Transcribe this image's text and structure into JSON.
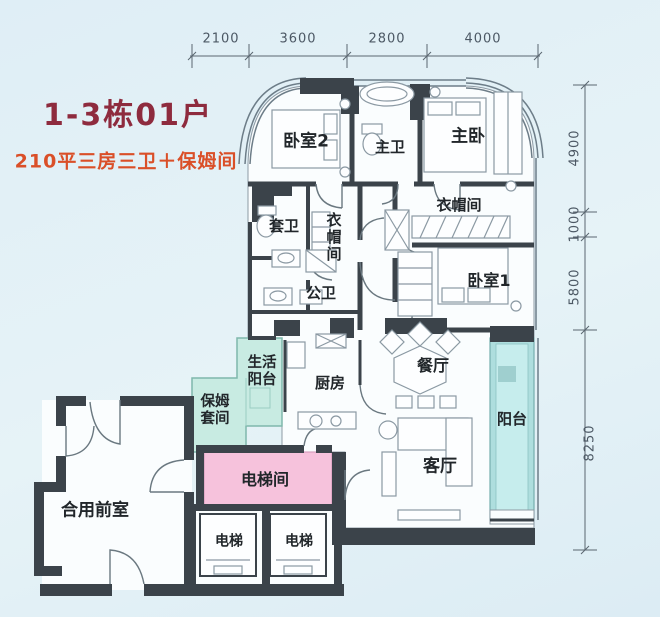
{
  "title": {
    "line1": "1-3栋01户",
    "line2": "210平三房三卫＋保姆间"
  },
  "dimensions": {
    "top": [
      "2100",
      "3600",
      "2800",
      "4000"
    ],
    "right": [
      "4900",
      "1000",
      "5800",
      "8250"
    ]
  },
  "rooms": {
    "bedroom2": "卧室2",
    "master_bath": "主卫",
    "master_bedroom": "主卧",
    "ensuite_bath": "套卫",
    "closet_center": "衣帽间",
    "closet_right": "衣帽间",
    "public_bath": "公卫",
    "bedroom1": "卧室1",
    "dining": "餐厅",
    "kitchen": "厨房",
    "service_balcony": "生活阳台",
    "nanny_suite": "保姆套间",
    "balcony": "阳台",
    "living": "客厅",
    "elevator_hall": "电梯间",
    "elevator": "电梯",
    "shared_vestibule": "合用前室"
  },
  "colors": {
    "background": "#e3f0f6",
    "wall": "#3b434a",
    "service_mint": "#c8ebe2",
    "balcony_teal": "#aedede",
    "elevator_pink": "#f6c2dc",
    "title_red": "#8e2b3e",
    "subtitle_orange": "#da4f28",
    "dim_text": "#4c5864",
    "label_text": "#21262a"
  }
}
